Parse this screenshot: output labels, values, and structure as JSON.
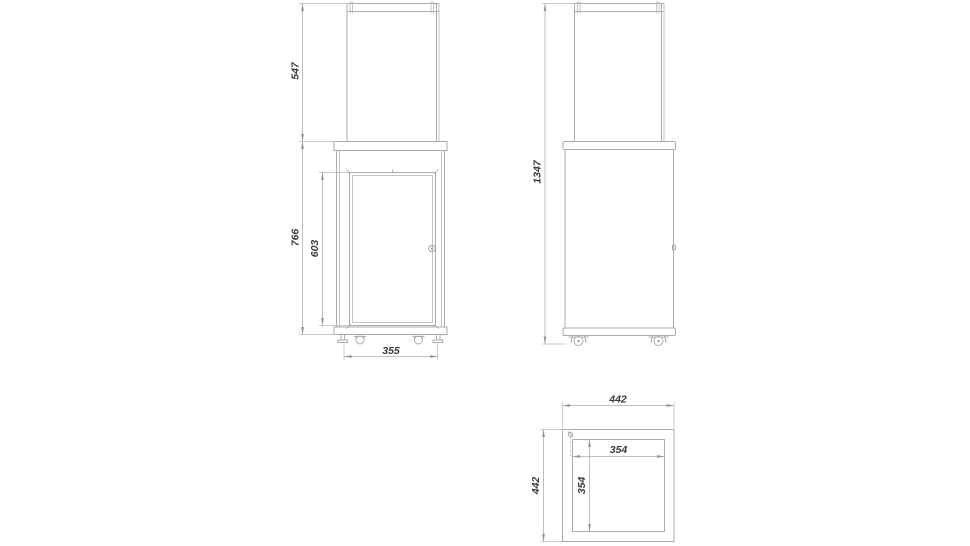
{
  "colors": {
    "background": "#ffffff",
    "line": "#a6acb0",
    "dimension_line": "#a9afb3",
    "text": "#3a3a3e"
  },
  "views": {
    "front": {
      "name": "front-view",
      "dimensions": {
        "glass_height": "547",
        "body_height": "766",
        "door_height": "603",
        "base_width": "355"
      }
    },
    "side": {
      "name": "side-view",
      "dimensions": {
        "overall_height": "1347"
      }
    },
    "top": {
      "name": "top-view",
      "dimensions": {
        "outer_width": "442",
        "outer_depth": "442",
        "inner_width": "354",
        "inner_depth": "354"
      }
    }
  }
}
